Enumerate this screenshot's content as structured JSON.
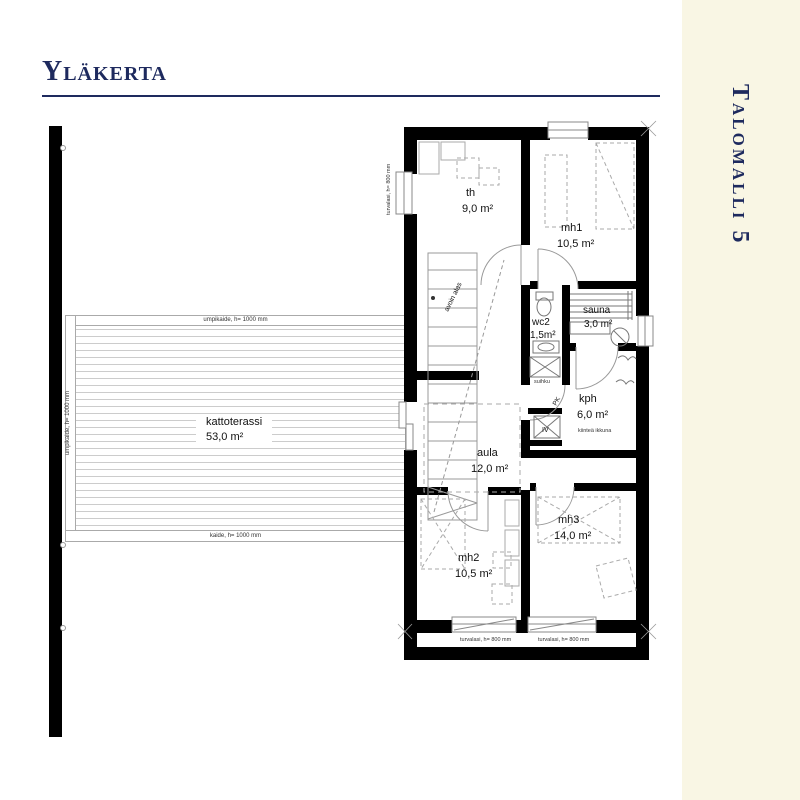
{
  "page": {
    "title": "Yläkerta",
    "sidebar_label": "Talomalli 5"
  },
  "colors": {
    "navy": "#1e2a5e",
    "sidebar_bg": "#f9f6e4",
    "wall": "#000000",
    "line_gray": "#999999"
  },
  "rooms": [
    {
      "name": "th",
      "area": "9,0  m²"
    },
    {
      "name": "mh1",
      "area": "10,5 m²"
    },
    {
      "name": "wc2",
      "area": "1,5m²"
    },
    {
      "name": "sauna",
      "area": "3,0  m²"
    },
    {
      "name": "kph",
      "area": "6,0  m²"
    },
    {
      "name": "aula",
      "area": "12,0 m²"
    },
    {
      "name": "mh2",
      "area": "10,5 m²"
    },
    {
      "name": "mh3",
      "area": "14,0 m²"
    },
    {
      "name": "kattoterassi",
      "area": "53,0  m²"
    }
  ],
  "annotations": {
    "railing_top": "umpikaide, h= 1000 mm",
    "railing_left": "umpikaide, h= 1000 mm",
    "railing_bottom": "kaide, h= 1000 mm",
    "window_left": "turvalasi, h= 800 mm",
    "window_bottom_left": "turvalasi, h= 800 mm",
    "window_bottom_right": "turvalasi, h= 800 mm",
    "stairs_open": "avoin alas",
    "shower": "suihku",
    "fixed_window": "kiinteä ikkuna",
    "washing_machine": "PK",
    "ventilation": "IV"
  }
}
